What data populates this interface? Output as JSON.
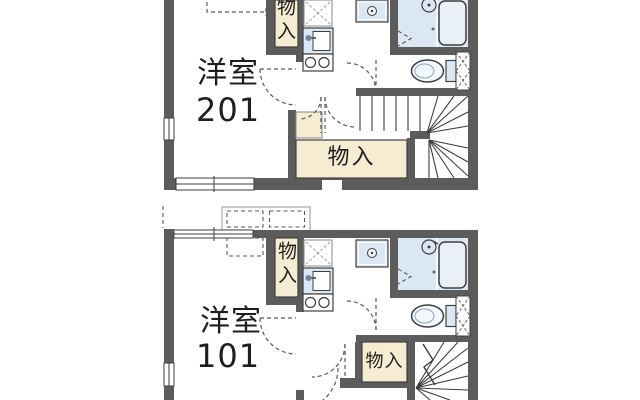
{
  "plan": {
    "type": "apartment-floor-plan",
    "units": [
      {
        "id": "201",
        "room_label": "洋室",
        "room_number": "201",
        "closet_label": "物入",
        "storage_label": "物入"
      },
      {
        "id": "101",
        "room_label": "洋室",
        "room_number": "101",
        "closet_label": "物入",
        "storage_label": "物入"
      }
    ]
  },
  "colors": {
    "wall": "#5c5c5c",
    "fixture_blue": "#dbe7f3",
    "bathtub_fill": "#e9f0f8",
    "storage_cream": "#f6ecd2",
    "line": "#3f3f3f",
    "dash_line": "#5a5a5a",
    "background": "#ffffff"
  }
}
